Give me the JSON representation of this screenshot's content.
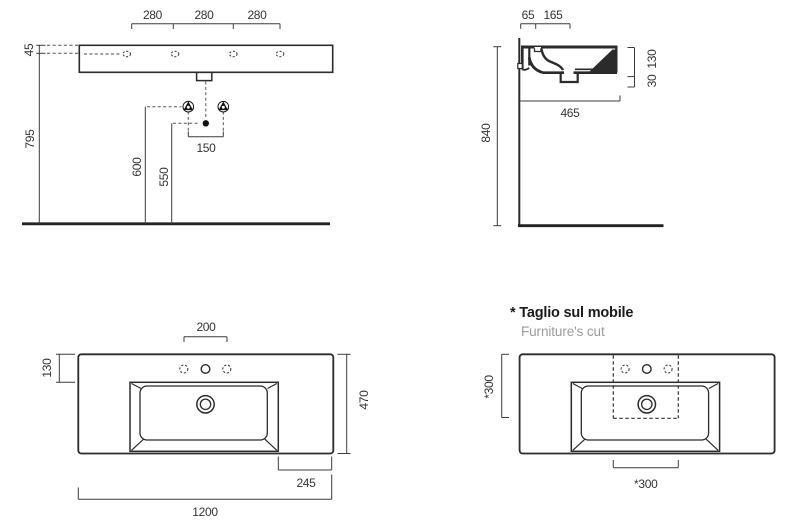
{
  "drawing": {
    "type": "technical-dimension-drawing",
    "subject": "wall-hung washbasin, four dimensioned views with furniture cut"
  },
  "colors": {
    "line": "#2b2b2b",
    "dim_line": "#3c3c3c",
    "dim_text": "#333333",
    "muted_text": "#9b9b9b",
    "background": "#ffffff"
  },
  "front_view": {
    "dim_280": [
      "280",
      "280",
      "280"
    ],
    "dim_45": "45",
    "dim_795": "795",
    "dim_600": "600",
    "dim_550": "550",
    "dim_150": "150"
  },
  "side_view": {
    "dim_65": "65",
    "dim_165": "165",
    "dim_840": "840",
    "dim_130": "130",
    "dim_30": "30",
    "dim_465": "465"
  },
  "top_view": {
    "dim_200": "200",
    "dim_130": "130",
    "dim_470": "470",
    "dim_245": "245",
    "dim_1200": "1200"
  },
  "furniture_cut_view": {
    "note_italian": "* Taglio sul mobile",
    "note_english": "Furniture's cut",
    "dim_300_vertical": "*300",
    "dim_300_horizontal": "*300"
  }
}
